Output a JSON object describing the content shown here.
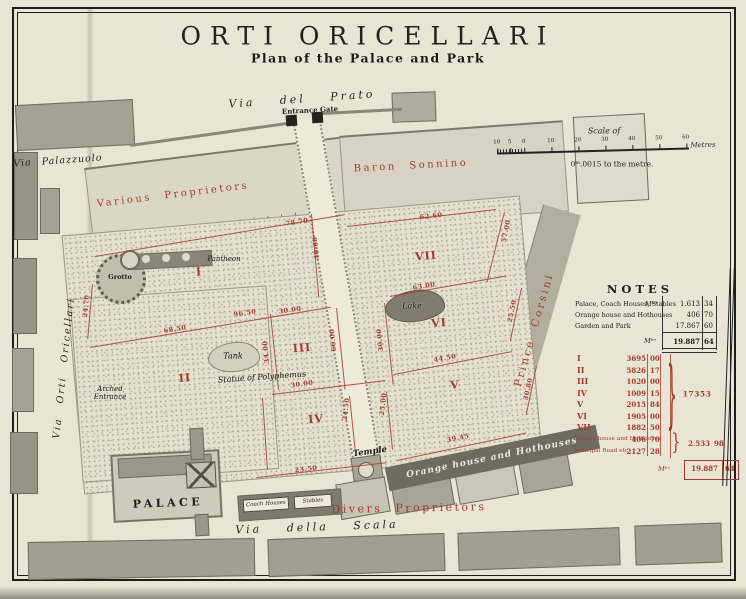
{
  "title": "ORTI ORICELLARI",
  "subtitle": "Plan of the Palace and Park",
  "scale": {
    "label": "Scale of",
    "ticks": [
      "10",
      "5",
      "0",
      "10",
      "20",
      "30",
      "40",
      "50",
      "60"
    ],
    "unit": "Metres",
    "ratio": "0ᵐ.0015 to the metre."
  },
  "streets": {
    "top": "Via del Prato",
    "left_top": "Via Palazzuolo",
    "left": "Via Orti Oricellari",
    "bottom": "Via della Scala"
  },
  "proprietors": {
    "various": "Various Proprietors",
    "baron": "Baron Sonnino",
    "prince": "Prince Corsini",
    "divers": "Divers Proprietors"
  },
  "features": {
    "entrance_gate": "Entrance Gate",
    "grotto": "Grotto",
    "pantheon": "Pantheon",
    "tank": "Tank",
    "statue": "Statue of Polyphemus",
    "lake": "Lake",
    "temple": "Temple",
    "arched_entrance": "Arched Entrance",
    "palace": "PALACE",
    "coach_houses": "Coach Houses",
    "stables": "Stables",
    "orange_house": "Orange house and Hothouses"
  },
  "parcels": [
    "I",
    "II",
    "III",
    "IV",
    "V",
    "VI",
    "VII"
  ],
  "measurements": [
    "78.70",
    "62.60",
    "40.60",
    "24.70",
    "96.50",
    "68.50",
    "30.00",
    "34.00",
    "66.00",
    "30.00",
    "30.00",
    "63.00",
    "57.00",
    "25.50",
    "44.50",
    "30.80",
    "39.45",
    "23.50",
    "24.50",
    "25.00"
  ],
  "notes": {
    "title": "NOTES",
    "rows": [
      {
        "label": "Palace, Coach Houses, Stables",
        "unit": "Mᵗʳⁱ",
        "value": "1.613",
        "cents": "34"
      },
      {
        "label": "Orange house and Hothouses",
        "unit": "",
        "value": "406",
        "cents": "70"
      },
      {
        "label": "Garden and Park",
        "unit": "",
        "value": "17.867",
        "cents": "60"
      }
    ],
    "total": {
      "unit": "Mᵗʳⁱ",
      "value": "19.887",
      "cents": "64"
    }
  },
  "area_table": {
    "bracket": "}",
    "rows": [
      {
        "label": "I",
        "value": "3695",
        "cents": "00"
      },
      {
        "label": "II",
        "value": "5826",
        "cents": "17"
      },
      {
        "label": "III",
        "value": "1020",
        "cents": "00"
      },
      {
        "label": "IV",
        "value": "1009",
        "cents": "15"
      },
      {
        "label": "V",
        "value": "2015",
        "cents": "84"
      },
      {
        "label": "VI",
        "value": "1905",
        "cents": "00"
      },
      {
        "label": "VII",
        "value": "1882",
        "cents": "50"
      },
      {
        "label": "Orange house and Hothouses",
        "value": "406",
        "cents": "70"
      },
      {
        "label": "Principal Road etc.",
        "value": "2127",
        "cents": "28"
      }
    ],
    "subtotal_parcels": "17353",
    "subtotal_other": {
      "value": "2.533",
      "cents": "98"
    },
    "total": {
      "unit": "Mᵗʳⁱ",
      "value": "19.887",
      "cents": "64"
    }
  },
  "colors": {
    "accent_red": "#a43a2e",
    "paper": "#e9e5d5",
    "block_gray": "#a5a193"
  }
}
